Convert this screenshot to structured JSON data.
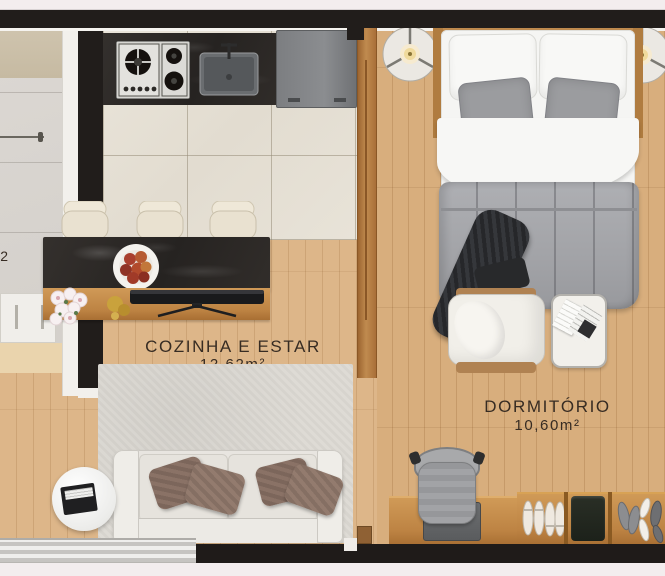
{
  "plan_type": "apartment-floor-plan",
  "labels": {
    "living": {
      "name": "COZINHA E ESTAR",
      "area": "12,62m²"
    },
    "bedroom": {
      "name": "DORMITÓRIO",
      "area": "10,60m²"
    },
    "adjacent_partial": "2"
  },
  "colors": {
    "wall": "#211d1b",
    "wood_floor": "#d9b183",
    "kitchen_tile": "#e7e2d7",
    "gray_tile": "#d8d4cf",
    "marble_counter": "#2b2826",
    "rug": "#dcd9d3",
    "furniture_wood": "#c58945",
    "text": "#372c23",
    "exterior": "#f3edee",
    "duvet_gray": "#a6a7ab",
    "sofa_cream": "#e8e5e0",
    "pillow_brown": "#8a7266"
  },
  "inventory": [
    "gas-cooktop",
    "kitchen-sink",
    "refrigerator",
    "kitchen-island",
    "bar-stools",
    "fruit-bowl",
    "flowers",
    "gold-decor",
    "tv",
    "sideboard",
    "sofa",
    "throw-pillows",
    "round-side-table",
    "books",
    "area-rug",
    "sliding-window",
    "double-bed",
    "nightstand-lamps",
    "throw-blanket",
    "armchair",
    "ottoman",
    "open-magazine",
    "desk",
    "laptop",
    "desk-chair",
    "shoe-rack",
    "shoes",
    "folded-clothes",
    "room-divider",
    "towel-bar",
    "bathroom-cabinet"
  ]
}
